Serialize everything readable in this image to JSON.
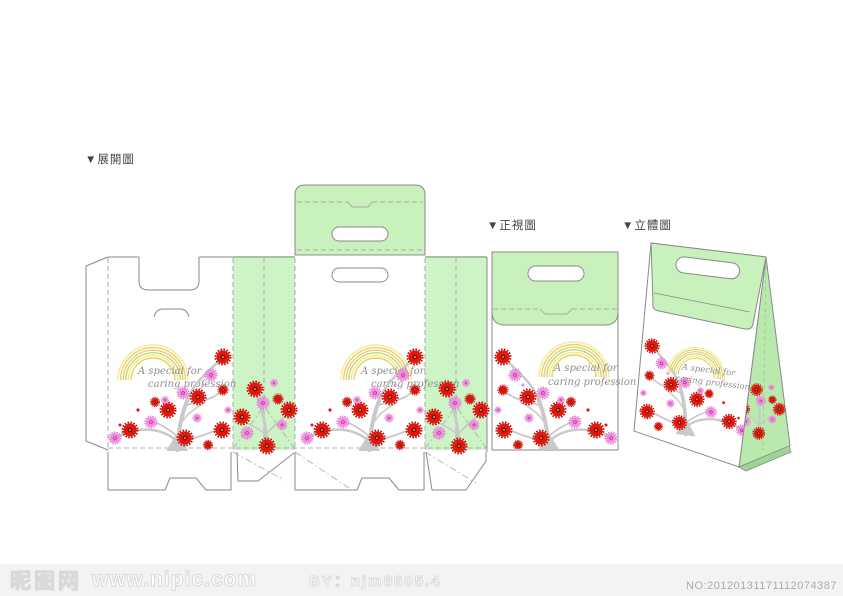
{
  "labels": {
    "unfolded_view": "▼展開圖",
    "front_view": "▼正視圖",
    "perspective_view": "▼立體圖"
  },
  "artwork": {
    "slogan_line1": "A special for",
    "slogan_line2": "caring profession",
    "colors": {
      "panel_green": "#cdf3c6",
      "side_green": "#b9e9ad",
      "flap_green": "#c9f1bc",
      "outline_gray": "#8a8a8a",
      "branch_gray": "#c9c9c9",
      "flower_red": "#e2180c",
      "flower_pink": "#f28ce0",
      "rainbow_yellow": "#ecd54f"
    }
  },
  "footer": {
    "site_name": "昵图网",
    "site_url": "www.nipic.com",
    "author": "BY：njm8605.4",
    "serial": "NO:20120131171112074387"
  }
}
